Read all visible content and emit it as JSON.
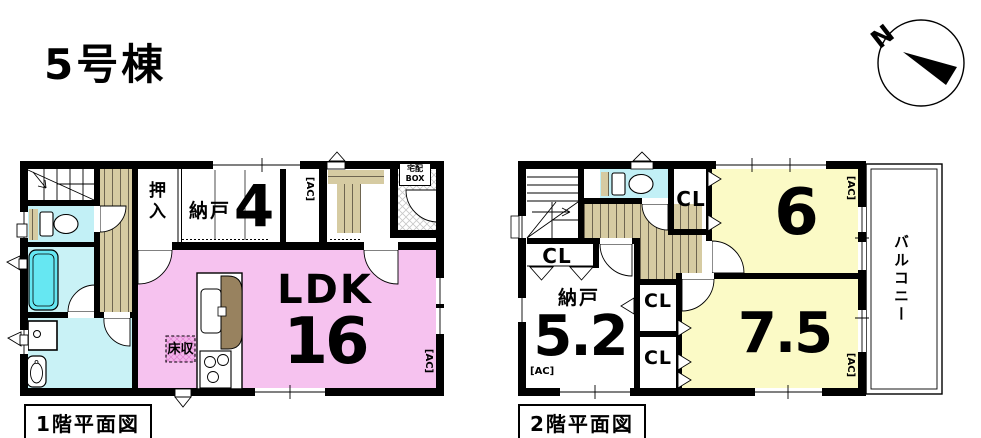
{
  "title": "5号棟",
  "compass": {
    "north": "N"
  },
  "colors": {
    "ldk_pink": "#F6C2EF",
    "room_yellow": "#FBFAC6",
    "water_cyan": "#C2F0F6",
    "bathtub_cyan": "#66E7F2",
    "wood_tan": "#D6CBA2",
    "counter_brown": "#98825F",
    "wall_black": "#000000"
  },
  "floor1": {
    "caption": "1階平面図",
    "labels": {
      "oshiire": "押入",
      "nando": "納戸",
      "nando_size": "4",
      "ldk": "LDK",
      "ldk_size": "16",
      "floor_storage": "床収",
      "delivery_box_line1": "宅配",
      "delivery_box_line2": "BOX",
      "ac_entrance": "[AC]",
      "ac_ldk": "[AC]"
    }
  },
  "floor2": {
    "caption": "2階平面図",
    "labels": {
      "closet_top": "CL",
      "closet_left": "CL",
      "closet_mid_upper": "CL",
      "closet_mid_lower": "CL",
      "room6_size": "6",
      "room75_size": "7.5",
      "nando": "納戸",
      "nando_size": "5.2",
      "balcony": "バルコニー",
      "ac_room6": "[AC]",
      "ac_nando": "[AC]",
      "ac_room75": "[AC]"
    }
  }
}
